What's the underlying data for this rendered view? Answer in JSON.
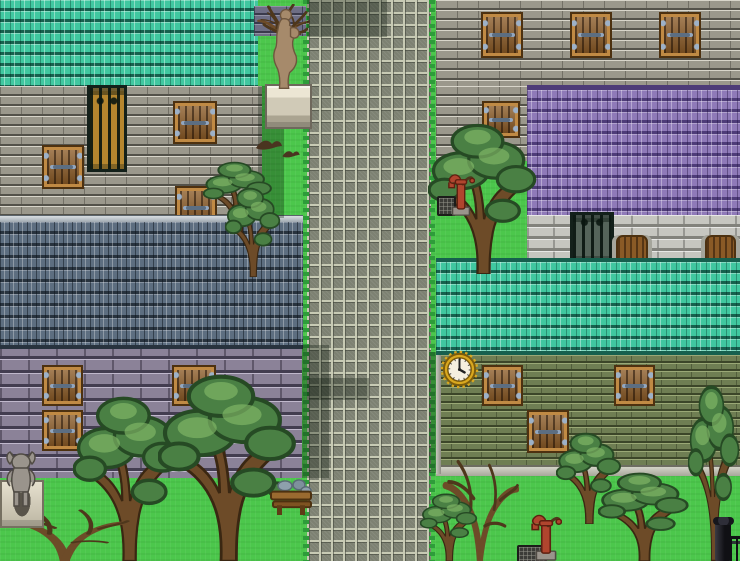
{
  "viewport": {
    "width": 740,
    "height": 561
  },
  "scene": {
    "kind": "top-down pixel-art town map",
    "terrain": {
      "grass_label": "Grass",
      "road_label": "Cobblestone road (north-south)"
    },
    "buildings": {
      "northwest": {
        "label": "Stone house with teal tiled roof",
        "windows": 4,
        "has_iron_gate": true
      },
      "west": {
        "label": "Stone house with slate-blue tiled roof and violet block walls",
        "windows": 3
      },
      "northeast": {
        "label": "Stone house with purple tiled roof",
        "windows": 4,
        "has_iron_gate": true,
        "wooden_doors": 2
      },
      "east": {
        "label": "Stone house with teal tiled roof and olive brick walls",
        "windows": 3,
        "has_wall_clock": true
      }
    },
    "objects": {
      "statue": {
        "label": "Weathered statue on stone pedestal"
      },
      "statue_wall": {
        "label": "Dark brick wall section behind statue"
      },
      "dead_tree_north": {
        "label": "Bare tree behind statue"
      },
      "birds": {
        "label": "Birds on the grass"
      },
      "clock": {
        "label": "Golden wall clock",
        "displayed_time": "4:00"
      },
      "pump_north": {
        "label": "Red hand water pump"
      },
      "pump_south": {
        "label": "Red hand water pump"
      },
      "drain_north": {
        "label": "Drain grate"
      },
      "drain_south": {
        "label": "Drain grate"
      },
      "gargoyle": {
        "label": "Gargoyle statue on stone base"
      },
      "bench": {
        "label": "Wooden bench with stones"
      },
      "fence": {
        "label": "Iron fence corner"
      },
      "gate_northwest": {
        "label": "Wrought-iron barred door"
      },
      "gate_northeast": {
        "label": "Wrought-iron gate"
      },
      "trees": {
        "label": "Gnarled leafy trees"
      },
      "dead_trees": {
        "label": "Bare dead trees"
      }
    }
  },
  "palette": {
    "grass": "#4cc74c",
    "grass-dark": "#2e9c3a",
    "road-tile": "#7d8172",
    "road-grout": "#c7cab4",
    "roof-teal": "#40c7a0",
    "roof-teal-dark": "#16604e",
    "roof-purple": "#8f7ab8",
    "roof-purple-dark": "#4e3c78",
    "roof-slate": "#5d6e80",
    "roof-slate-dark": "#28333e",
    "wall-gray": "#9b988c",
    "wall-gray-dark": "#54524a",
    "wall-gray-light": "#d8d5ca",
    "wall-violet": "#8b8298",
    "wall-violet-dark": "#433d50",
    "wall-violet-light": "#c0b8cc",
    "wall-olive": "#6f7e53",
    "wall-olive-dark": "#3c4629",
    "wall-olive-light": "#9aa876",
    "wall-white": "#c6c6c0",
    "wall-white-dark": "#82827c",
    "wall-dark-brick": "#6e6e85",
    "wall-dark-brick-dark": "#3a3a4c",
    "wood": "#8a5a26",
    "wood-dark": "#4d3110",
    "wood-light": "#c08a44",
    "hinge": "#9db1c8",
    "iron": "#13201a",
    "statue-bronze": "#a68a6b",
    "clock-gold": "#d9a81f",
    "clock-face": "#f5efdf",
    "foliage": "#4a8044",
    "foliage-dark": "#264a24",
    "foliage-light": "#83b968",
    "trunk": "#6d4b28",
    "trunk-dark": "#3a2712",
    "pump-red": "#b0452e",
    "shadow": "rgba(12,24,12,0.32)"
  }
}
